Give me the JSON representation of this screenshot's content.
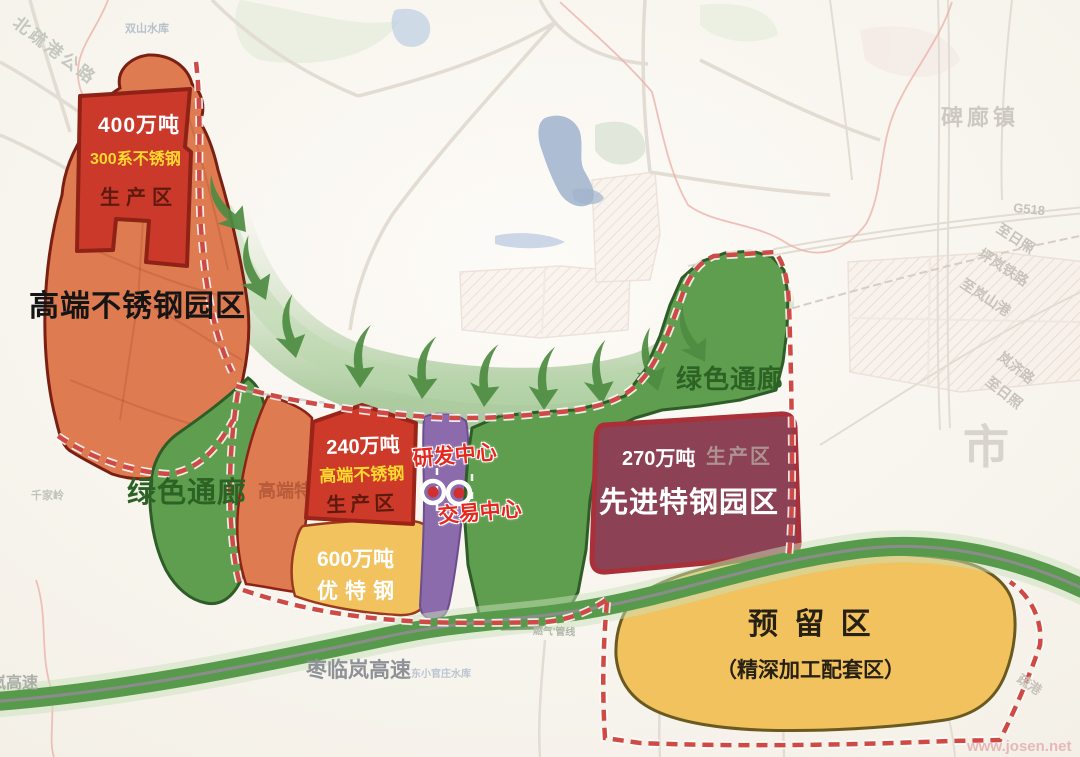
{
  "zones": {
    "nw_park": {
      "label": "高端不锈钢园区",
      "capacity": "400万吨",
      "product": "300系不锈钢",
      "type": "生产区"
    },
    "mid_block": {
      "capacity": "240万吨",
      "product": "高端不锈钢",
      "type": "生产区",
      "bg_label": "高端特钢"
    },
    "youte_block": {
      "capacity": "600万吨",
      "name": "优特钢"
    },
    "advanced_park": {
      "capacity": "270万吨",
      "type": "生产区",
      "label": "先进特钢园区"
    },
    "reserved": {
      "label": "预 留 区",
      "sublabel": "（精深加工配套区）"
    },
    "green_corridor_left": {
      "label": "绿色通廊"
    },
    "green_corridor_right": {
      "label": "绿色通廊"
    },
    "rd_center": {
      "label": "研发中心"
    },
    "trade_center": {
      "label": "交易中心"
    }
  },
  "roads": {
    "zaolinlan_expressway": "枣临岚高速",
    "expressway_left_partial": "岚高速",
    "north_shugang_road": "北疏港公路",
    "g518": "G518",
    "to_rizhao_north": "至日照",
    "pinglan_railway": "坪岚铁路",
    "to_lanshan_port": "至岚山港",
    "lanji_road": "岚济路",
    "to_rizhao_south": "至日照",
    "shugang_partial": "疏港"
  },
  "places": {
    "beilang_town": "碑廊镇",
    "city_partial": "市",
    "shuangshan_reservoir": "双山水库",
    "qianjialing": "千家岭",
    "dongxiaoguanzhuang_reservoir": "东小官庄水库",
    "gas_pipeline": "燃气'管线"
  },
  "watermark": "www.josen.net",
  "colors": {
    "zone_orange": "#de7b51",
    "zone_red": "#cb392b",
    "zone_yellow": "#f1c25e",
    "zone_purple": "#8c6bac",
    "zone_green": "#609e4f",
    "zone_maroon": "#8c4154",
    "boundary_dash": "#cf4a45",
    "highway_green": "#589a4b",
    "text_yellow": "#ffd92e",
    "text_dark_red": "#5e1a0e"
  }
}
